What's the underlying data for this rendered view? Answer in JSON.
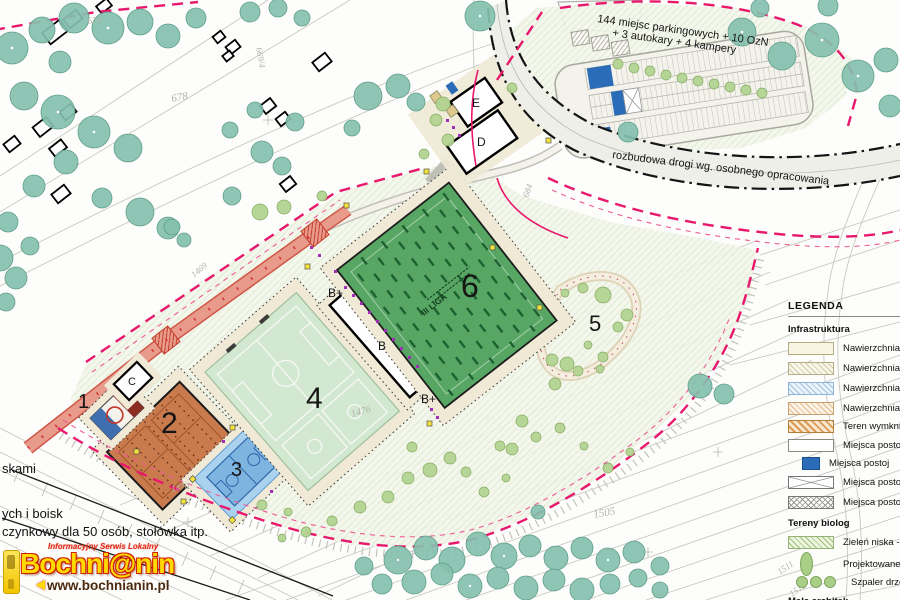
{
  "map": {
    "parking_note_line1": "144 miejsc parkingowych + 10 OzN",
    "parking_note_line2": "+ 3 autokary + 4 kampery",
    "road_note": "rozbudowa drogi wg. osobnego opracowania",
    "field6_text": "III LIGA",
    "field_labels": {
      "n1": "1",
      "n2": "2",
      "n3": "3",
      "n4": "4",
      "n5": "5",
      "n6": "6"
    },
    "building_labels": {
      "b": "B",
      "bplus1": "B+",
      "bplus2": "B+",
      "c": "C",
      "d": "D",
      "e": "E"
    },
    "parcel_numbers": {
      "p676": "676",
      "p6694": "669/4",
      "p678": "678",
      "p1469": "1469",
      "p684": "684",
      "p1476": "1476",
      "p1470": "1470",
      "p1505": "1505",
      "p1511": "1511",
      "p1512": "1512"
    }
  },
  "legend": {
    "title": "LEGENDA",
    "section_infrastructure": "Infrastruktura",
    "r_naw1": "Nawierzchnia",
    "r_naw2": "Nawierzchnia",
    "r_naw3": "Nawierzchnia",
    "r_naw4": "Nawierzchnia",
    "r_teren": "Teren wymkni",
    "r_mp1": "Miejsca postoj",
    "r_mp2": "Miejsca postoj",
    "r_mp3": "Miejsca postoj",
    "r_mp4": "Miejsca postoj",
    "section_bio": "Tereny biolog",
    "r_zielen": "Zieleń niska -",
    "r_proj": "Projektowane",
    "r_szpaler": "Szpaler drzew",
    "section_mala": "Mała architek"
  },
  "annotations": {
    "line1": "skami",
    "line2": "ych i boisk",
    "line3": "czynkowy dla 50 osób, stołówka itp."
  },
  "watermark": {
    "slogan": "Informacyjny Serwis Lokalny",
    "name": "Bochni@nin",
    "url": "www.bochnianin.pl"
  },
  "colors": {
    "boundary_magenta": "#e8186d",
    "field_green": "#57a663",
    "clay_orange": "#c97b4e",
    "court_blue": "#7db4e0",
    "parking_blue": "#2b6cb8",
    "tree_existing": "#85c0ae",
    "tree_projected": "#b2d492",
    "road_salmon": "#e89a8b"
  }
}
